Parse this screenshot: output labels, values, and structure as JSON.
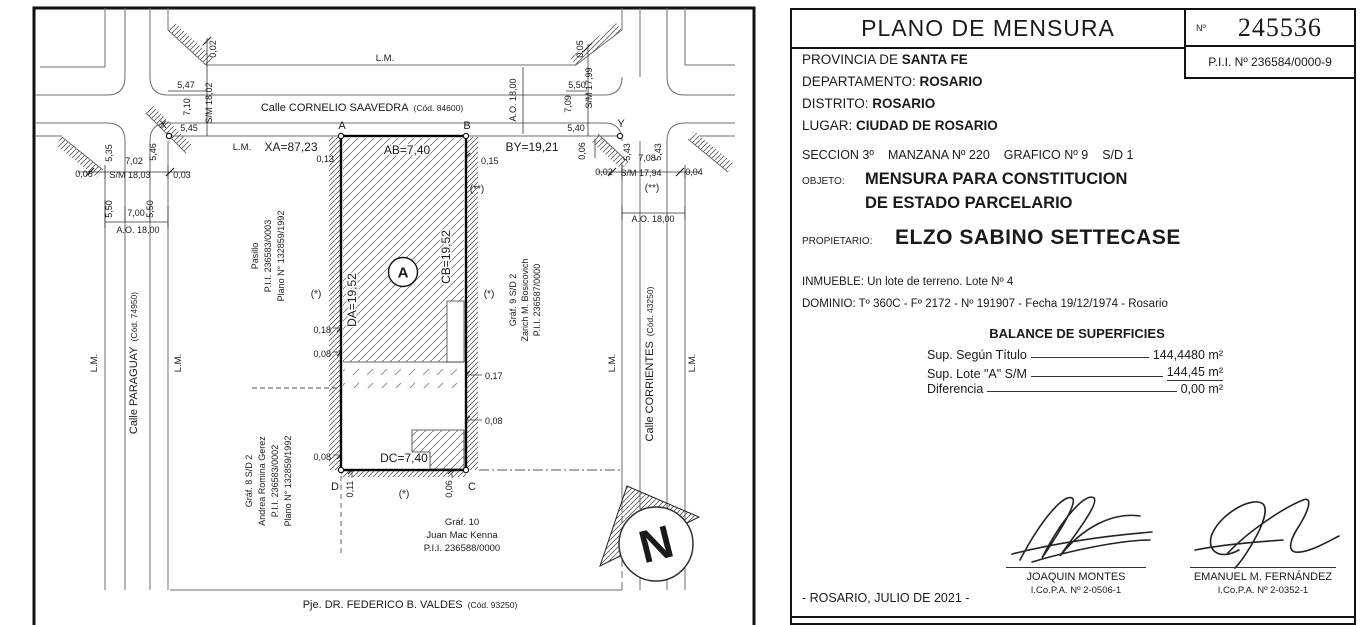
{
  "plan": {
    "lm": "L.M.",
    "streets": {
      "saavedra": {
        "name": "Calle CORNELIO SAAVEDRA",
        "code": "(Cód. 84600)"
      },
      "paraguay": {
        "name": "Calle PARAGUAY",
        "code": "(Cód. 74950)"
      },
      "corrientes": {
        "name": "Calle CORRIENTES",
        "code": "(Cód. 43250)"
      },
      "valdes": {
        "name": "Pje. DR. FEDERICO B. VALDES",
        "code": "(Cód. 93250)"
      }
    },
    "points": {
      "A": "A",
      "B": "B",
      "C": "C",
      "D": "D",
      "X": "X",
      "Y": "Y"
    },
    "sides": {
      "xa": "XA=87,23",
      "ab": "AB=7,40",
      "by": "BY=19,21",
      "da": "DA=19,52",
      "cb": "CB=19,52",
      "dc": "DC=7,40"
    },
    "lot_label": "A",
    "marks": {
      "star": "(*)",
      "dstar": "(**)"
    },
    "dims": {
      "lt_off": "0,02",
      "lt_1": "5,47",
      "lt_2": "7,10",
      "lt_sm": "S/M 18,02",
      "x_side": "5,45",
      "w_1": "5,35",
      "w_2": "7,02",
      "w_3": "5,46",
      "w_off1": "0,06",
      "w_sm": "S/M 18,03",
      "w_off2": "0,03",
      "p_1": "5,50",
      "p_2": "7,00",
      "p_3": "5,50",
      "p_ao": "A.O. 18,00",
      "s_ao": "A.O. 18,00",
      "rt_off": "0,05",
      "rt_1": "5,50",
      "rt_2": "7,09",
      "rt_sm": "S/M 17,99",
      "rt_3": "5,40",
      "y_off": "0,06",
      "e_1": "5,43",
      "e_2": "7,08",
      "e_3": "5,43",
      "e_off1": "0,02",
      "e_sm": "S/M 17,94",
      "e_off2": "0,04",
      "c_ao": "A.O. 18,00",
      "lot_tl": "0,13",
      "lot_tr": "0,15",
      "lot_l1": "0,18",
      "lot_l2": "0,08",
      "lot_l3": "0,08",
      "lot_r1": "0,17",
      "lot_r2": "0,08",
      "lot_bl": "0,11",
      "lot_br": "0,06"
    },
    "neighbors": {
      "pasillo": [
        "Pasillo",
        "P.I.I. 236583/0003",
        "Plano N° 132859/1992"
      ],
      "gerez": [
        "Gráf. 8 S/D 2",
        "Andrea Romina Gerez",
        "P.I.I. 236583/0002",
        "Plano N° 132859/1992"
      ],
      "bosicovich": [
        "Gráf. 9 S/D 2",
        "Zarich M. Bosicovich",
        "P.I.I. 236587/0000"
      ],
      "mackenna": [
        "Gráf. 10",
        "Juan Mac Kenna",
        "P.I.I. 236588/0000"
      ]
    },
    "compass_n": "N"
  },
  "panel": {
    "title": "PLANO DE MENSURA",
    "num_label": "Nº",
    "num": "245536",
    "pii": "P.I.I. Nº 236584/0000-9",
    "provincia_label": "PROVINCIA DE ",
    "provincia": "SANTA FE",
    "departamento_label": "DEPARTAMENTO: ",
    "departamento": "ROSARIO",
    "distrito_label": "DISTRITO: ",
    "distrito": "ROSARIO",
    "lugar_label": "LUGAR: ",
    "lugar": "CIUDAD DE ROSARIO",
    "seccion": "SECCION 3º",
    "manzana": "MANZANA Nº 220",
    "grafico": "GRAFICO Nº 9",
    "sd": "S/D 1",
    "objeto_label": "OBJETO:",
    "objeto_1": "MENSURA PARA CONSTITUCION",
    "objeto_2": "DE ESTADO PARCELARIO",
    "propietario_label": "PROPIETARIO:",
    "propietario": "ELZO SABINO SETTECASE",
    "inmueble": "INMUEBLE: Un lote de terreno. Lote Nº 4",
    "dominio": "DOMINIO: Tº 360C - Fº 2172 - Nº 191907 - Fecha 19/12/1974 - Rosario",
    "balance_title": "BALANCE DE SUPERFICIES",
    "bal1_label": "Sup. Según Título",
    "bal1_value": "144,4480 m²",
    "bal2_label": "Sup. Lote \"A\" S/M",
    "bal2_value": "144,45 m²",
    "bal3_label": "Diferencia",
    "bal3_value": "0,00 m²",
    "sig1_name": "JOAQUIN MONTES",
    "sig1_reg": "I.Co.P.A. Nº 2-0506-1",
    "sig2_name": "EMANUEL M. FERNÁNDEZ",
    "sig2_reg": "I.Co.P.A. Nº 2-0352-1",
    "date": "- ROSARIO, JULIO DE 2021 -"
  }
}
